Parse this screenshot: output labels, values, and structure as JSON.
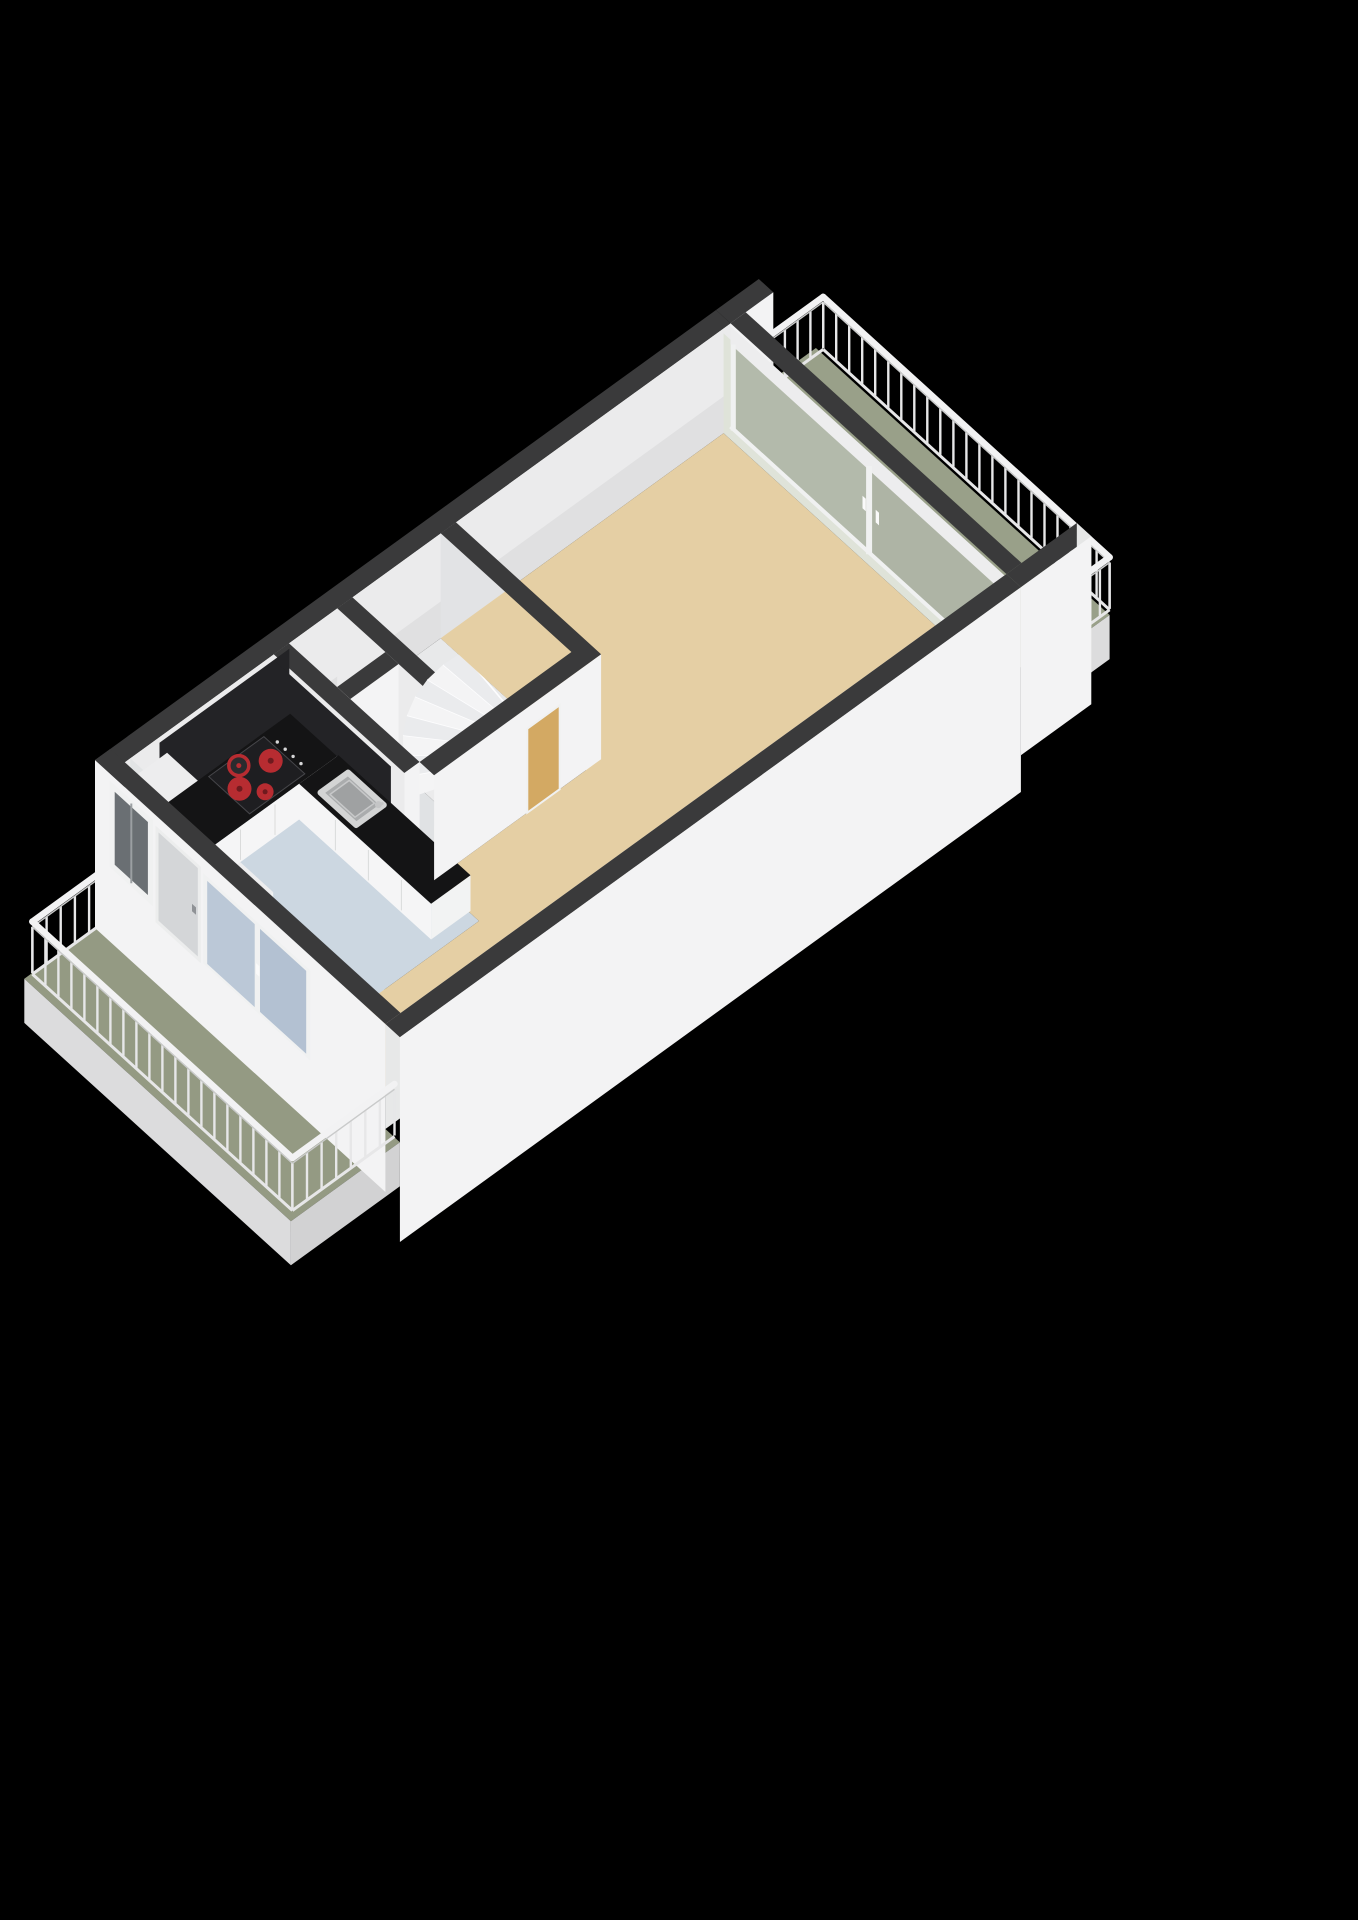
{
  "app": {
    "title": "3d-floorplan-render",
    "background": "#000000"
  },
  "scene": {
    "type": "floorplan-3d-cutaway",
    "rooms": [
      {
        "name": "living-room",
        "floor_color": "#e5cfa4"
      },
      {
        "name": "kitchen",
        "floor_color": "#ccd7e1",
        "fixtures": [
          "l-shaped-counter",
          "cooktop",
          "sink",
          "tall-cabinet",
          "corner-unit"
        ]
      },
      {
        "name": "stair-hall",
        "floor_color": "#e8e9ea",
        "fixtures": [
          "winder-staircase"
        ]
      },
      {
        "name": "storage-closet-a",
        "floor_color": "#e0e2e4"
      },
      {
        "name": "storage-closet-b",
        "floor_color": "#e0e2e4"
      },
      {
        "name": "balcony-rear",
        "floor_color": "#99a089",
        "features": [
          "white-railing",
          "sliding-glass-wall-2-panels"
        ]
      },
      {
        "name": "balcony-front",
        "floor_color": "#949a83",
        "features": [
          "white-railing",
          "balcony-door",
          "window",
          "sliding-glass-panel-2-panes"
        ]
      }
    ],
    "cooktop": {
      "burners": 4,
      "burner_color": "#b72c31",
      "panel_color": "#1e1e21",
      "knobs": 4
    },
    "staircase": {
      "steps": 8,
      "style": "winder-fan"
    },
    "doors": [
      {
        "name": "living-room-door",
        "color": "#d3a963"
      },
      {
        "name": "balcony-door",
        "color": "#d4d6d8"
      }
    ],
    "palette": {
      "background": "#000000",
      "wall_top": "#3a3a3b",
      "wall_face_ext": "#f3f3f4",
      "wall_face_int": "#ebebec",
      "wall_face_int_shade": "#e2e3e5",
      "wall_inner_backing": "#e2e4e5",
      "se_wall_inner": "#e7e8e8",
      "glazing_backing": "#dfe3d9",
      "floor_living": "#e5cfa4",
      "floor_kitchen": "#ccd7e1",
      "floor_balcony_ne": "#99a089",
      "floor_balcony_sw": "#949a83",
      "floor_closet": "#e0e2e4",
      "floor_stair": "#e8e9ea",
      "fascia": "#dcdcdd",
      "fascia_dark": "#d2d2d3",
      "counter_top": "#141415",
      "counter_front": "#f5f5f6",
      "backsplash": "#232326",
      "cooktop_panel": "#1e1e21",
      "burner": "#b72c31",
      "burner_center": "#6f1a1e",
      "burner_ring_fill": "#2b2b2e",
      "knob": "#d6d6d7",
      "sink_rim": "#d3d4d4",
      "sink_basin": "#aaacad",
      "sink_inner": "#9fa1a2",
      "faucet": "#c4c5c6",
      "cabinet_front": "#f2f3f3",
      "cabinet_side": "#e5e6e6",
      "cabinet_top": "#ededee",
      "door_interior": "#d3a963",
      "door_balcony": "#d4d6d8",
      "door_handle": "#8f9296",
      "glass_ne": "#a7ae9e",
      "glass_ne2": "#a3aa9a",
      "glass_sw": "#b6c4d5",
      "glass_sw2": "#aebdcf",
      "glass_window": "#6a6f73",
      "frame_white": "#f0f1f1",
      "header": "#ededee",
      "railing_post": "#e7e7e8",
      "railing_top": "#f2f2f3",
      "stair_light": "#f4f4f5",
      "stair_dark": "#eaebed",
      "stair_edge": "#fdfdfe",
      "seam": "#dadbdb"
    }
  }
}
